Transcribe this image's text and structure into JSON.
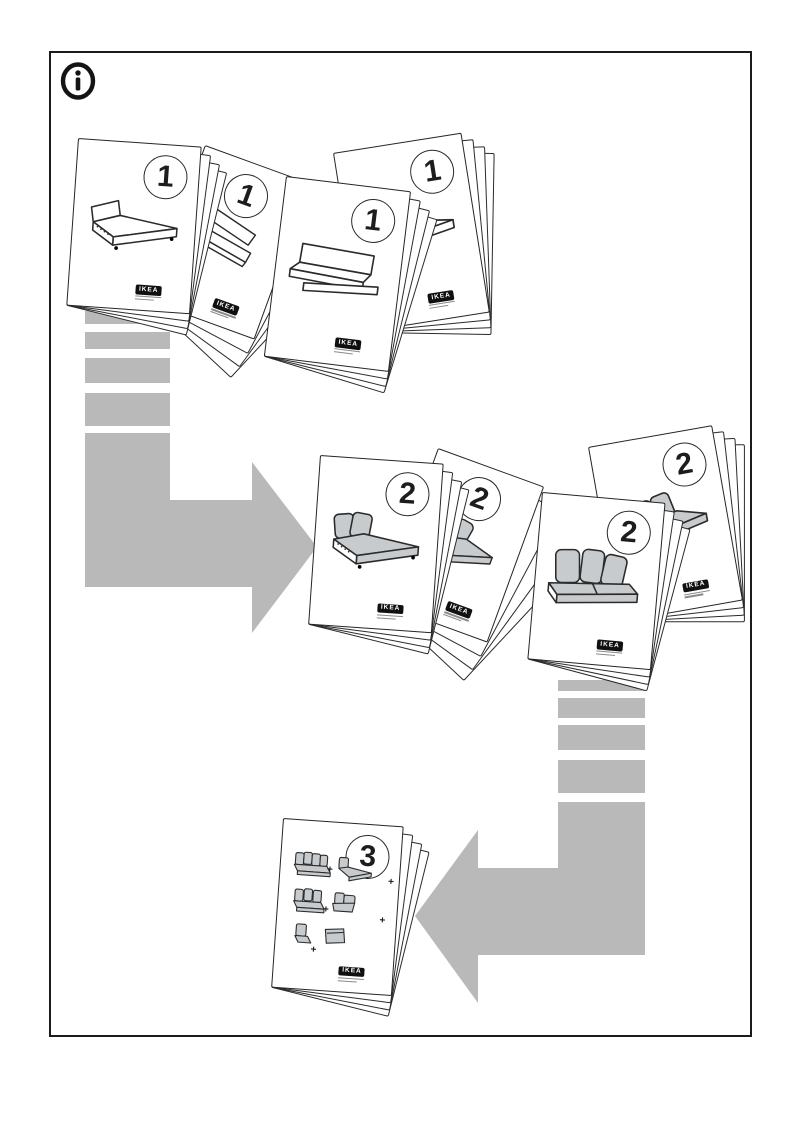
{
  "page": {
    "background": "#ffffff",
    "frame_color": "#1b1b1b"
  },
  "colors": {
    "arrow_gray": "#b9b9b9",
    "furniture_gray": "#c7cbcd",
    "line": "#2b2b2b"
  },
  "icons": {
    "info": "circled-i"
  },
  "steps": [
    {
      "number": "1",
      "booklet_count": 4
    },
    {
      "number": "2",
      "booklet_count": 4
    },
    {
      "number": "3",
      "booklet_count": 1
    }
  ],
  "logo": {
    "text": "IKEA"
  },
  "plus": "+"
}
